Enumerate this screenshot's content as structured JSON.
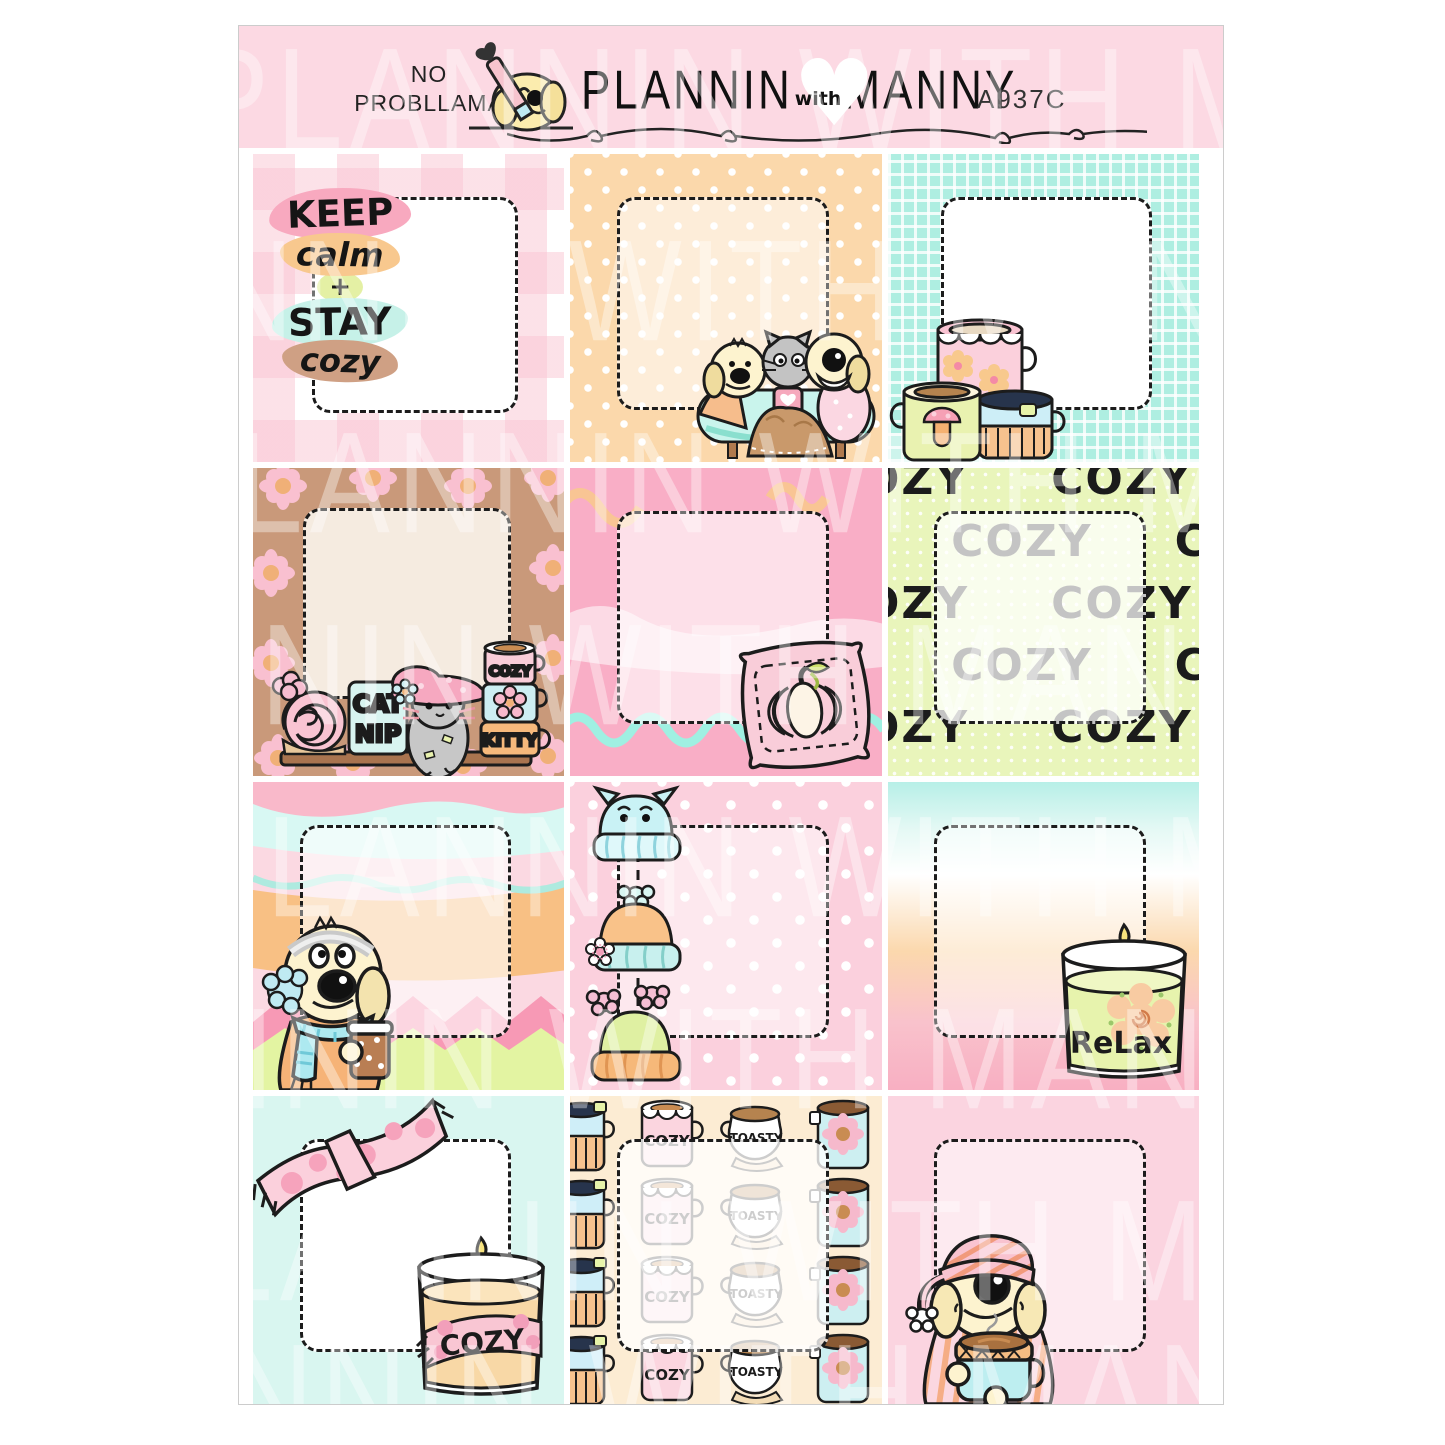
{
  "header": {
    "tagline_line1": "NO",
    "tagline_line2": "PROBLLAMA",
    "brand_first": "PLANNIN",
    "brand_with": "with",
    "brand_last": "MANNY",
    "product_code": "A937C"
  },
  "watermark": {
    "text": "PLANNIN WITH MANNY"
  },
  "colors": {
    "header_pink": "#fcd9e3",
    "peach": "#fbd8ab",
    "aqua": "#aeeee1",
    "brown": "#c9997a",
    "hot_pink": "#f9aec6",
    "pastel_green": "#e9f5bb",
    "mint": "#d9f6f0",
    "cream": "#fcecd3",
    "light_pink": "#fbd4e0"
  },
  "boxes": {
    "keep_calm": {
      "line1": "KEEP",
      "line2": "calm",
      "line3": "+",
      "line4": "STAY",
      "line5": "cozy"
    },
    "cat_shelf": {
      "canister_top": "CAT",
      "canister_bottom": "NIP",
      "mug_top": "COZY",
      "mug_bottom": "KITTY"
    },
    "cozy_words": {
      "word": "COZY"
    },
    "relax_candle": {
      "label": "ReLax"
    },
    "cozy_candle": {
      "label": "COZY"
    },
    "mug_pattern": {
      "cozy": "COZY",
      "toasty": "TOASTY"
    }
  }
}
